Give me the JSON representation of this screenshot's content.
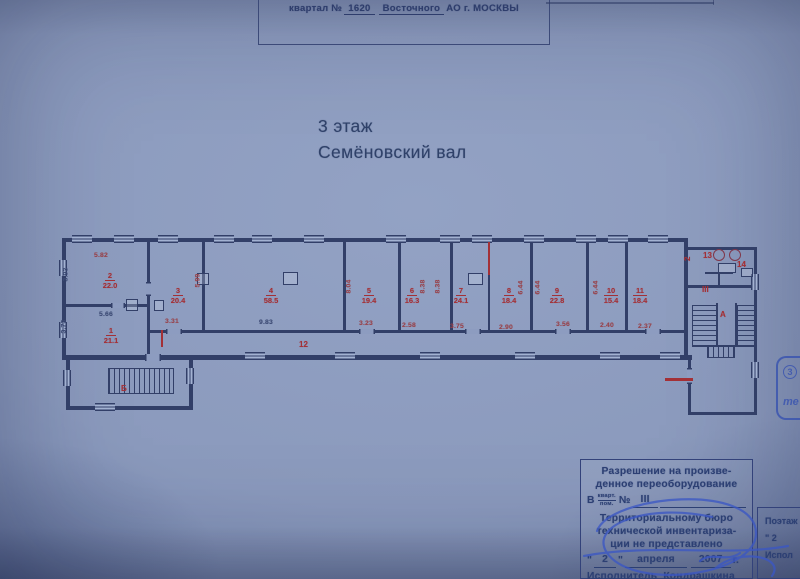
{
  "colors": {
    "plan_line": "#323f68",
    "red": "#a33036",
    "dark_dim": "#3c4a74",
    "ink_blue": "#3b57c4",
    "text_navy": "#2c3f73"
  },
  "header": {
    "prefix": "квартал №",
    "block_no": "1620",
    "district": "Восточного",
    "suffix": "АО г. МОСКВЫ"
  },
  "title": {
    "line1": "3 этаж",
    "line2": "Семёновский вал"
  },
  "plan": {
    "rooms": [
      {
        "no": "1",
        "area": "21.1",
        "x": 56,
        "y": 96
      },
      {
        "no": "2",
        "area": "22.0",
        "x": 55,
        "y": 41
      },
      {
        "no": "3",
        "area": "20.4",
        "x": 123,
        "y": 56
      },
      {
        "no": "4",
        "area": "58.5",
        "x": 216,
        "y": 56
      },
      {
        "no": "5",
        "area": "19.4",
        "x": 314,
        "y": 56
      },
      {
        "no": "6",
        "area": "16.3",
        "x": 357,
        "y": 56
      },
      {
        "no": "7",
        "area": "24.1",
        "x": 406,
        "y": 56
      },
      {
        "no": "8",
        "area": "18.4",
        "x": 454,
        "y": 56
      },
      {
        "no": "9",
        "area": "22.8",
        "x": 502,
        "y": 56
      },
      {
        "no": "10",
        "area": "15.4",
        "x": 556,
        "y": 56
      },
      {
        "no": "11",
        "area": "18.4",
        "x": 585,
        "y": 56
      }
    ],
    "labels": [
      {
        "text": "12",
        "x": 244,
        "y": 110,
        "name": "corridor-label"
      },
      {
        "text": "13",
        "x": 648,
        "y": 21,
        "name": "room-13-label"
      },
      {
        "text": "14",
        "x": 682,
        "y": 30,
        "name": "room-14-label"
      },
      {
        "text": "III",
        "x": 647,
        "y": 55,
        "name": "apartment-number-label"
      },
      {
        "text": "А",
        "x": 665,
        "y": 80,
        "name": "staircase-a-label"
      },
      {
        "text": "Б",
        "x": 66,
        "y": 154,
        "name": "staircase-b-label"
      },
      {
        "text": "2",
        "x": 625,
        "y": 18,
        "vertical": true,
        "name": "mark-2-label"
      }
    ],
    "dimensions": [
      {
        "text": "5.82",
        "x": 46,
        "y": 22
      },
      {
        "text": "3.93",
        "x": 12,
        "y": 40,
        "v": 1,
        "dark": 1
      },
      {
        "text": "5.66",
        "x": 51,
        "y": 81,
        "dark": 1
      },
      {
        "text": "3.73",
        "x": 10,
        "y": 92,
        "v": 1,
        "dark": 1
      },
      {
        "text": "3.31",
        "x": 117,
        "y": 88
      },
      {
        "text": "5.99",
        "x": 144,
        "y": 46,
        "v": 1
      },
      {
        "text": "9.83",
        "x": 211,
        "y": 89,
        "dark": 1
      },
      {
        "text": "3.23",
        "x": 311,
        "y": 90
      },
      {
        "text": "8.04",
        "x": 295,
        "y": 52,
        "v": 1
      },
      {
        "text": "8.38",
        "x": 369,
        "y": 52,
        "v": 1
      },
      {
        "text": "8.38",
        "x": 384,
        "y": 52,
        "v": 1
      },
      {
        "text": "2.58",
        "x": 354,
        "y": 92
      },
      {
        "text": "3.75",
        "x": 402,
        "y": 93
      },
      {
        "text": "2.90",
        "x": 451,
        "y": 94
      },
      {
        "text": "6.44",
        "x": 467,
        "y": 53,
        "v": 1
      },
      {
        "text": "6.44",
        "x": 484,
        "y": 53,
        "v": 1
      },
      {
        "text": "6.44",
        "x": 542,
        "y": 53,
        "v": 1
      },
      {
        "text": "3.56",
        "x": 508,
        "y": 91
      },
      {
        "text": "2.40",
        "x": 552,
        "y": 92
      },
      {
        "text": "2.37",
        "x": 590,
        "y": 93
      }
    ]
  },
  "permit": {
    "line1": "Разрешение на произве-",
    "line2": "денное переоборудование",
    "in_label": "В",
    "frac_top": "кварт.",
    "frac_bottom": "пом.",
    "number_sign": "№",
    "apartment": "III",
    "line4": "Территориальному бюро",
    "line5": "технической инвентариза-",
    "line6": "ции не представлено",
    "quote": "\"",
    "day": "2",
    "month": "апреля",
    "year": "2007",
    "year_suffix": "г.",
    "executor_label": "Исполнитель",
    "executor_name": "Кондрашкина"
  },
  "side_note": {
    "line1": "Поэтаж",
    "line2": "\" 2",
    "line3": "Испол"
  },
  "stamp": {
    "floor": "3",
    "text": "те"
  }
}
